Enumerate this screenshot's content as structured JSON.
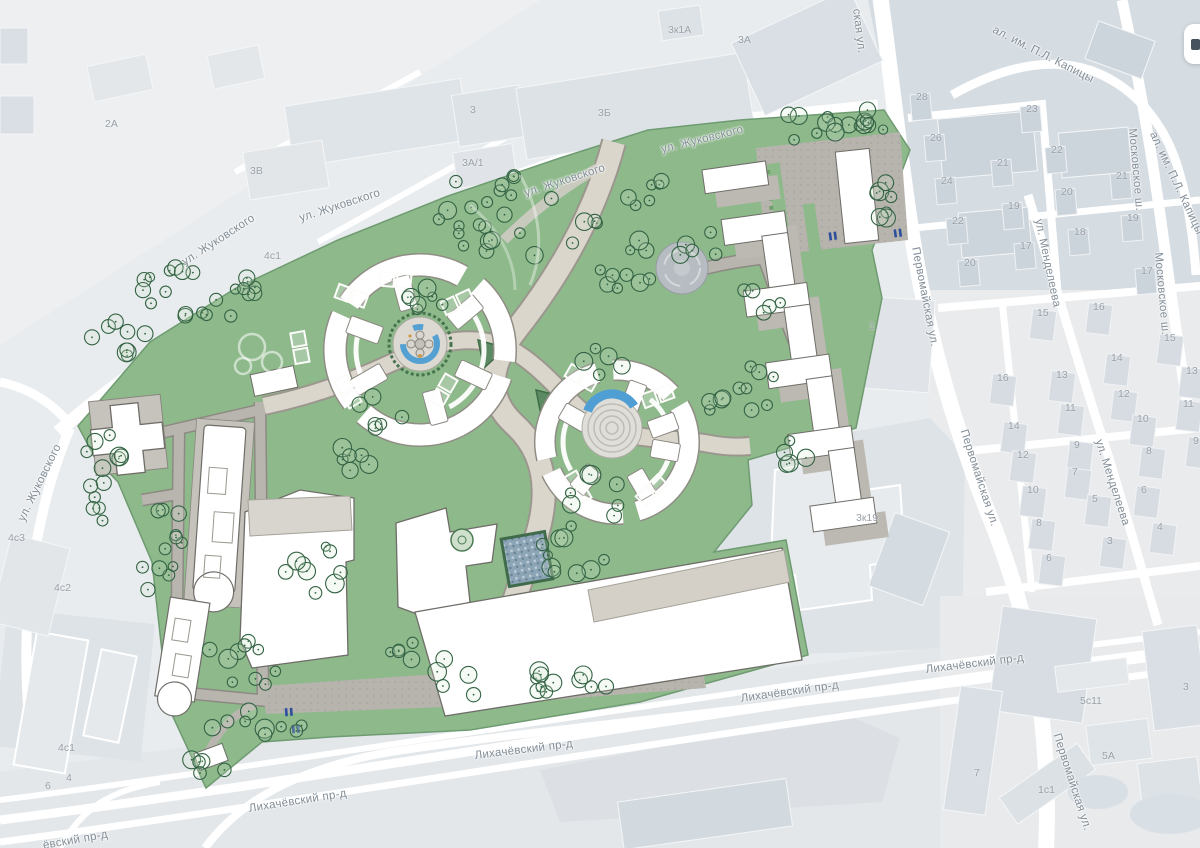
{
  "map": {
    "colors": {
      "plan_green": "#8eb98b",
      "tree_outline": "#336344",
      "water_blue": "#55a0d2",
      "path_gray": "#b7b4ae",
      "promenade": "#dad6cc",
      "base_building": "#d6dce2",
      "road_white": "#ffffff",
      "label_gray": "#828d97"
    },
    "controls": {
      "top_right_button_icon": "panel-icon"
    },
    "street_labels": [
      {
        "text": "ул. Жуковского",
        "x": 180,
        "y": 258,
        "rot": -33
      },
      {
        "text": "ул. Жуковского",
        "x": 298,
        "y": 213,
        "rot": -18
      },
      {
        "text": "ул. Жуковского",
        "x": 523,
        "y": 188,
        "rot": -18
      },
      {
        "text": "ул. Жуковского",
        "x": 660,
        "y": 144,
        "rot": -14
      },
      {
        "text": "ул. Жуковского",
        "x": 16,
        "y": 518,
        "rot": -64
      },
      {
        "text": "ская ул.",
        "x": 862,
        "y": 8,
        "rot": 83
      },
      {
        "text": "Первомайская ул.",
        "x": 921,
        "y": 246,
        "rot": 79
      },
      {
        "text": "Первомайская ул.",
        "x": 969,
        "y": 428,
        "rot": 72
      },
      {
        "text": "Первомайская ул.",
        "x": 1062,
        "y": 732,
        "rot": 72
      },
      {
        "text": "ал. им. П.Л. Капицы",
        "x": 996,
        "y": 24,
        "rot": 27
      },
      {
        "text": "ал. им. П.Л. Капицы",
        "x": 1158,
        "y": 130,
        "rot": 65
      },
      {
        "text": "Московское ш.",
        "x": 1138,
        "y": 128,
        "rot": 85
      },
      {
        "text": "Московское ш.",
        "x": 1164,
        "y": 252,
        "rot": 85
      },
      {
        "text": "ул. Менделеева",
        "x": 1044,
        "y": 218,
        "rot": 78
      },
      {
        "text": "ул. Менделеева",
        "x": 1104,
        "y": 438,
        "rot": 72
      },
      {
        "text": "Лихачёвский пр-д",
        "x": 925,
        "y": 664,
        "rot": -7
      },
      {
        "text": "Лихачёвский пр-д",
        "x": 740,
        "y": 693,
        "rot": -8
      },
      {
        "text": "Лихачёвский пр-д",
        "x": 474,
        "y": 750,
        "rot": -7
      },
      {
        "text": "Лихачёвский пр-д",
        "x": 248,
        "y": 803,
        "rot": -9
      },
      {
        "text": "ёвский пр-д",
        "x": 42,
        "y": 840,
        "rot": -10
      }
    ],
    "building_labels": [
      {
        "text": "2А",
        "x": 105,
        "y": 118
      },
      {
        "text": "3В",
        "x": 250,
        "y": 165
      },
      {
        "text": "4с1",
        "x": 264,
        "y": 250
      },
      {
        "text": "3к1А",
        "x": 668,
        "y": 24
      },
      {
        "text": "3А",
        "x": 738,
        "y": 34
      },
      {
        "text": "3",
        "x": 470,
        "y": 104
      },
      {
        "text": "3Б",
        "x": 598,
        "y": 107
      },
      {
        "text": "3А/1",
        "x": 462,
        "y": 157
      },
      {
        "text": "28",
        "x": 916,
        "y": 91
      },
      {
        "text": "23",
        "x": 1026,
        "y": 103
      },
      {
        "text": "26",
        "x": 930,
        "y": 132
      },
      {
        "text": "22",
        "x": 1051,
        "y": 144
      },
      {
        "text": "21",
        "x": 997,
        "y": 157
      },
      {
        "text": "21",
        "x": 1116,
        "y": 170
      },
      {
        "text": "24",
        "x": 941,
        "y": 175
      },
      {
        "text": "20",
        "x": 1061,
        "y": 186
      },
      {
        "text": "19",
        "x": 1008,
        "y": 200
      },
      {
        "text": "19",
        "x": 1127,
        "y": 212
      },
      {
        "text": "22",
        "x": 952,
        "y": 215
      },
      {
        "text": "18",
        "x": 1074,
        "y": 226
      },
      {
        "text": "17",
        "x": 1020,
        "y": 240
      },
      {
        "text": "20",
        "x": 964,
        "y": 257
      },
      {
        "text": "17",
        "x": 1141,
        "y": 265
      },
      {
        "text": "15",
        "x": 1037,
        "y": 307
      },
      {
        "text": "16",
        "x": 1093,
        "y": 301
      },
      {
        "text": "16",
        "x": 997,
        "y": 372
      },
      {
        "text": "14",
        "x": 1111,
        "y": 352
      },
      {
        "text": "15",
        "x": 1164,
        "y": 332
      },
      {
        "text": "13",
        "x": 1056,
        "y": 369
      },
      {
        "text": "13",
        "x": 1186,
        "y": 365
      },
      {
        "text": "11",
        "x": 1065,
        "y": 402
      },
      {
        "text": "12",
        "x": 1118,
        "y": 388
      },
      {
        "text": "11",
        "x": 1183,
        "y": 398
      },
      {
        "text": "10",
        "x": 1137,
        "y": 413
      },
      {
        "text": "14",
        "x": 1008,
        "y": 420
      },
      {
        "text": "9",
        "x": 1074,
        "y": 439
      },
      {
        "text": "12",
        "x": 1017,
        "y": 449
      },
      {
        "text": "8",
        "x": 1146,
        "y": 445
      },
      {
        "text": "9",
        "x": 1193,
        "y": 435
      },
      {
        "text": "7",
        "x": 1072,
        "y": 466
      },
      {
        "text": "10",
        "x": 1027,
        "y": 484
      },
      {
        "text": "5",
        "x": 1092,
        "y": 493
      },
      {
        "text": "6",
        "x": 1141,
        "y": 484
      },
      {
        "text": "8",
        "x": 1036,
        "y": 517
      },
      {
        "text": "3",
        "x": 1107,
        "y": 535
      },
      {
        "text": "6",
        "x": 1046,
        "y": 552
      },
      {
        "text": "4",
        "x": 1157,
        "y": 521
      },
      {
        "text": "1",
        "x": 869,
        "y": 320
      },
      {
        "text": "3к19",
        "x": 856,
        "y": 512
      },
      {
        "text": "4с3",
        "x": 8,
        "y": 532
      },
      {
        "text": "4с2",
        "x": 54,
        "y": 582
      },
      {
        "text": "4с1",
        "x": 58,
        "y": 742
      },
      {
        "text": "4",
        "x": 66,
        "y": 772
      },
      {
        "text": "6",
        "x": 45,
        "y": 780
      },
      {
        "text": "5с11",
        "x": 1080,
        "y": 695
      },
      {
        "text": "5А",
        "x": 1102,
        "y": 750
      },
      {
        "text": "3",
        "x": 1183,
        "y": 681
      },
      {
        "text": "7",
        "x": 974,
        "y": 767
      },
      {
        "text": "1с1",
        "x": 1038,
        "y": 784
      }
    ]
  }
}
